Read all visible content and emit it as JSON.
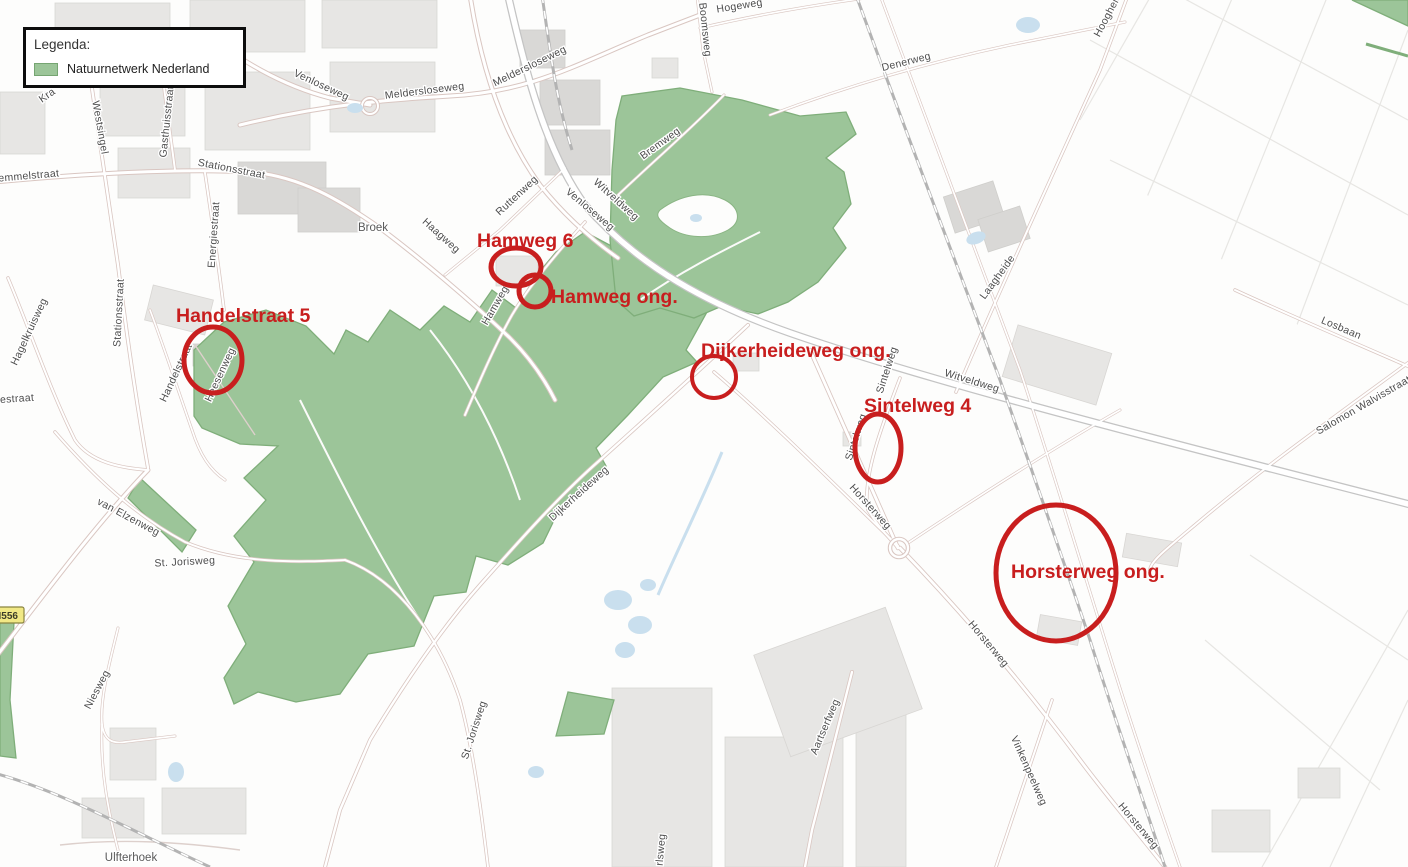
{
  "legend": {
    "title": "Legenda:",
    "items": [
      {
        "label": "Natuurnetwerk Nederland",
        "swatch_color": "#9cc599",
        "swatch_border": "#76a572"
      }
    ]
  },
  "annotations": [
    {
      "id": "handelstraat-5",
      "label": "Handelstraat 5",
      "label_x": 176,
      "label_y": 322,
      "cx": 213,
      "cy": 360,
      "rx": 29,
      "ry": 33,
      "stroke_w": 5
    },
    {
      "id": "hamweg-6",
      "label": "Hamweg 6",
      "label_x": 477,
      "label_y": 247,
      "cx": 516,
      "cy": 267,
      "rx": 25,
      "ry": 19,
      "stroke_w": 5
    },
    {
      "id": "hamweg-ong",
      "label": "Hamweg ong.",
      "label_x": 551,
      "label_y": 303,
      "cx": 535,
      "cy": 291,
      "rx": 16,
      "ry": 16,
      "stroke_w": 5
    },
    {
      "id": "dijkerheideweg-ong",
      "label": "Dijkerheideweg ong.",
      "label_x": 701,
      "label_y": 357,
      "cx": 714,
      "cy": 377,
      "rx": 22,
      "ry": 21,
      "stroke_w": 4
    },
    {
      "id": "sintelweg-4",
      "label": "Sintelweg 4",
      "label_x": 864,
      "label_y": 412,
      "cx": 878,
      "cy": 448,
      "rx": 23,
      "ry": 34,
      "stroke_w": 5
    },
    {
      "id": "horsterweg-ong",
      "label": "Horsterweg ong.",
      "label_x": 1011,
      "label_y": 578,
      "cx": 1056,
      "cy": 573,
      "rx": 60,
      "ry": 68,
      "stroke_w": 5
    }
  ],
  "street_labels": [
    {
      "text": "Venloseweg",
      "x": 320,
      "y": 88,
      "angle": 25
    },
    {
      "text": "Meldersloseweg",
      "x": 425,
      "y": 94,
      "angle": -7
    },
    {
      "text": "Meldersloseweg",
      "x": 531,
      "y": 69,
      "angle": -26
    },
    {
      "text": "Boomsweg",
      "x": 702,
      "y": 30,
      "angle": 84
    },
    {
      "text": "Hogeweg",
      "x": 740,
      "y": 9,
      "angle": -9
    },
    {
      "text": "Denerweg",
      "x": 907,
      "y": 65,
      "angle": -14
    },
    {
      "text": "Bremweg",
      "x": 662,
      "y": 146,
      "angle": -36
    },
    {
      "text": "Hoogheide",
      "x": 1112,
      "y": 14,
      "angle": -62
    },
    {
      "text": "Westsingel",
      "x": 97,
      "y": 128,
      "angle": 80
    },
    {
      "text": "Gasthuisstraat",
      "x": 170,
      "y": 122,
      "angle": -84
    },
    {
      "text": "Stationsstraat",
      "x": 231,
      "y": 172,
      "angle": 11
    },
    {
      "text": "emmelstraat",
      "x": 29,
      "y": 179,
      "angle": -5
    },
    {
      "text": "Kra",
      "x": 49,
      "y": 98,
      "angle": -35
    },
    {
      "text": "Energiestraat",
      "x": 217,
      "y": 235,
      "angle": -86
    },
    {
      "text": "Stationsstraat",
      "x": 122,
      "y": 313,
      "angle": -87
    },
    {
      "text": "Hagelkruisweg",
      "x": 32,
      "y": 333,
      "angle": -65
    },
    {
      "text": "jestraat",
      "x": 16,
      "y": 402,
      "angle": -4
    },
    {
      "text": "Handelstraat",
      "x": 179,
      "y": 374,
      "angle": -65
    },
    {
      "text": "Heesenweg",
      "x": 223,
      "y": 376,
      "angle": -65
    },
    {
      "text": "Haagweg",
      "x": 439,
      "y": 238,
      "angle": 42
    },
    {
      "text": "Ruttenweg",
      "x": 519,
      "y": 198,
      "angle": -43
    },
    {
      "text": "Venloseweg",
      "x": 588,
      "y": 212,
      "angle": 40
    },
    {
      "text": "Witveldweg",
      "x": 614,
      "y": 202,
      "angle": 42
    },
    {
      "text": "Hamweg",
      "x": 498,
      "y": 307,
      "angle": -60
    },
    {
      "text": "Dijkerheideweg",
      "x": 581,
      "y": 496,
      "angle": -42
    },
    {
      "text": "van Elzenweg",
      "x": 127,
      "y": 520,
      "angle": 28
    },
    {
      "text": "St. Jorisweg",
      "x": 185,
      "y": 565,
      "angle": -3
    },
    {
      "text": "Niesweg",
      "x": 100,
      "y": 691,
      "angle": -62
    },
    {
      "text": "St. Jorisweg",
      "x": 477,
      "y": 731,
      "angle": -72
    },
    {
      "text": "rlsweg",
      "x": 664,
      "y": 850,
      "angle": -85
    },
    {
      "text": "Sintelweg",
      "x": 890,
      "y": 371,
      "angle": -72
    },
    {
      "text": "Sintelweg",
      "x": 859,
      "y": 438,
      "angle": -72
    },
    {
      "text": "Witveldweg",
      "x": 971,
      "y": 384,
      "angle": 17
    },
    {
      "text": "Laagheide",
      "x": 1000,
      "y": 279,
      "angle": -54
    },
    {
      "text": "Losbaan",
      "x": 1340,
      "y": 331,
      "angle": 23
    },
    {
      "text": "Salomon Walvisstraat",
      "x": 1365,
      "y": 408,
      "angle": -30
    },
    {
      "text": "Horsterweg",
      "x": 868,
      "y": 509,
      "angle": 48
    },
    {
      "text": "Horsterweg",
      "x": 986,
      "y": 646,
      "angle": 50
    },
    {
      "text": "Horsterweg",
      "x": 1136,
      "y": 828,
      "angle": 50
    },
    {
      "text": "Aartserfweg",
      "x": 828,
      "y": 728,
      "angle": -67
    },
    {
      "text": "Vinkenpeelweg",
      "x": 1026,
      "y": 772,
      "angle": 66
    }
  ],
  "place_labels": [
    {
      "text": "Broek",
      "x": 373,
      "y": 231
    },
    {
      "text": "Ulfterhoek",
      "x": 131,
      "y": 861
    }
  ],
  "road_badge": {
    "text": "N556"
  },
  "colors": {
    "annotation_red": "#c81e1e",
    "nature_green": "#9cc599",
    "nature_border": "#7fae7a",
    "water_blue": "#c9dfee",
    "label_gray": "#4d4d4d",
    "badge_bg": "#f1e885",
    "badge_border": "#8a8440"
  }
}
